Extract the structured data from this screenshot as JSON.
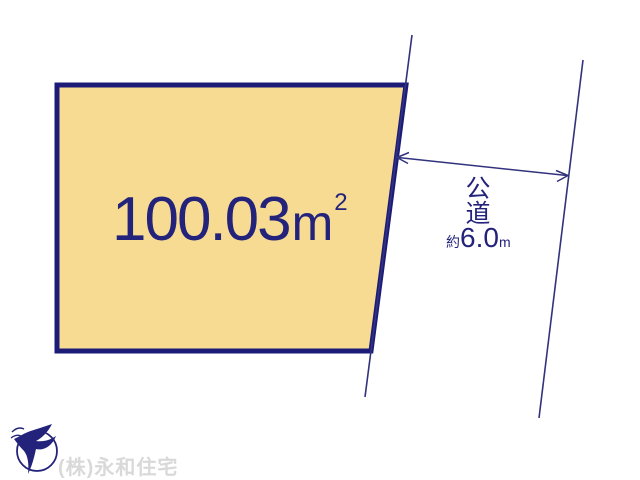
{
  "canvas": {
    "width": 640,
    "height": 480,
    "background": "#FFFFFF"
  },
  "plot": {
    "area_value": "100.03",
    "area_unit": "m",
    "area_exponent": "2",
    "fill_color": "#F8DB93",
    "border_color": "#1C1C78"
  },
  "road": {
    "name_line1": "公",
    "name_line2": "道",
    "width_approx_prefix": "約",
    "width_value": "6.0",
    "width_unit": "m",
    "line_color": "#32327E"
  },
  "dimension_arrow": {
    "color": "#32327E"
  },
  "footer": {
    "company_name": "(株)永和住宅",
    "logo_icon": "bird-in-circle-logo",
    "text_color": "#D9D9D9",
    "logo_color": "#23237B"
  },
  "accent_color": "#23237B"
}
